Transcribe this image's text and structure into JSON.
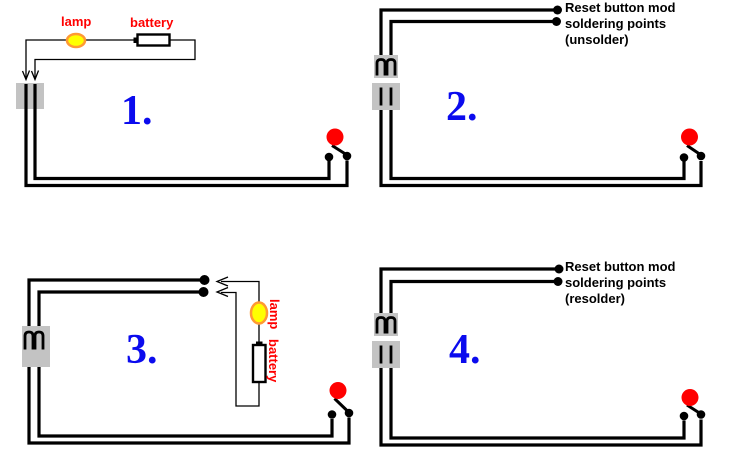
{
  "diagram": {
    "kind": "reset-button-mod-wiring-steps",
    "colors": {
      "label_red": "#ff0000",
      "number_blue": "#0b0bee",
      "lamp_fill": "#ffff00",
      "lamp_ring": "#ff9933",
      "connector_gray": "#c3c3c3",
      "button_red": "#ff0000",
      "wire_black": "#000000",
      "background": "#ffffff"
    },
    "icons": {
      "lamp-icon": "yellow ellipse with orange ring",
      "battery-icon": "white rectangle with black border and terminal nub",
      "connector-plug-icon": "gray block with two prong staples",
      "connector-socket-icon": "gray block with two slots",
      "reset-button-icon": "red circle with lever and two contact dots",
      "solder-point-dot": "black filled dot",
      "arrow-icon": "thin black arrowhead"
    }
  },
  "panels": [
    {
      "number": "1.",
      "lamp_label": "lamp",
      "battery_label": "battery"
    },
    {
      "number": "2.",
      "note": {
        "line1": "Reset button mod",
        "line2": "soldering points",
        "line3": "(unsolder)"
      }
    },
    {
      "number": "3.",
      "lamp_label": "lamp",
      "battery_label": "battery"
    },
    {
      "number": "4.",
      "note": {
        "line1": "Reset button mod",
        "line2": "soldering points",
        "line3": "(resolder)"
      }
    }
  ]
}
